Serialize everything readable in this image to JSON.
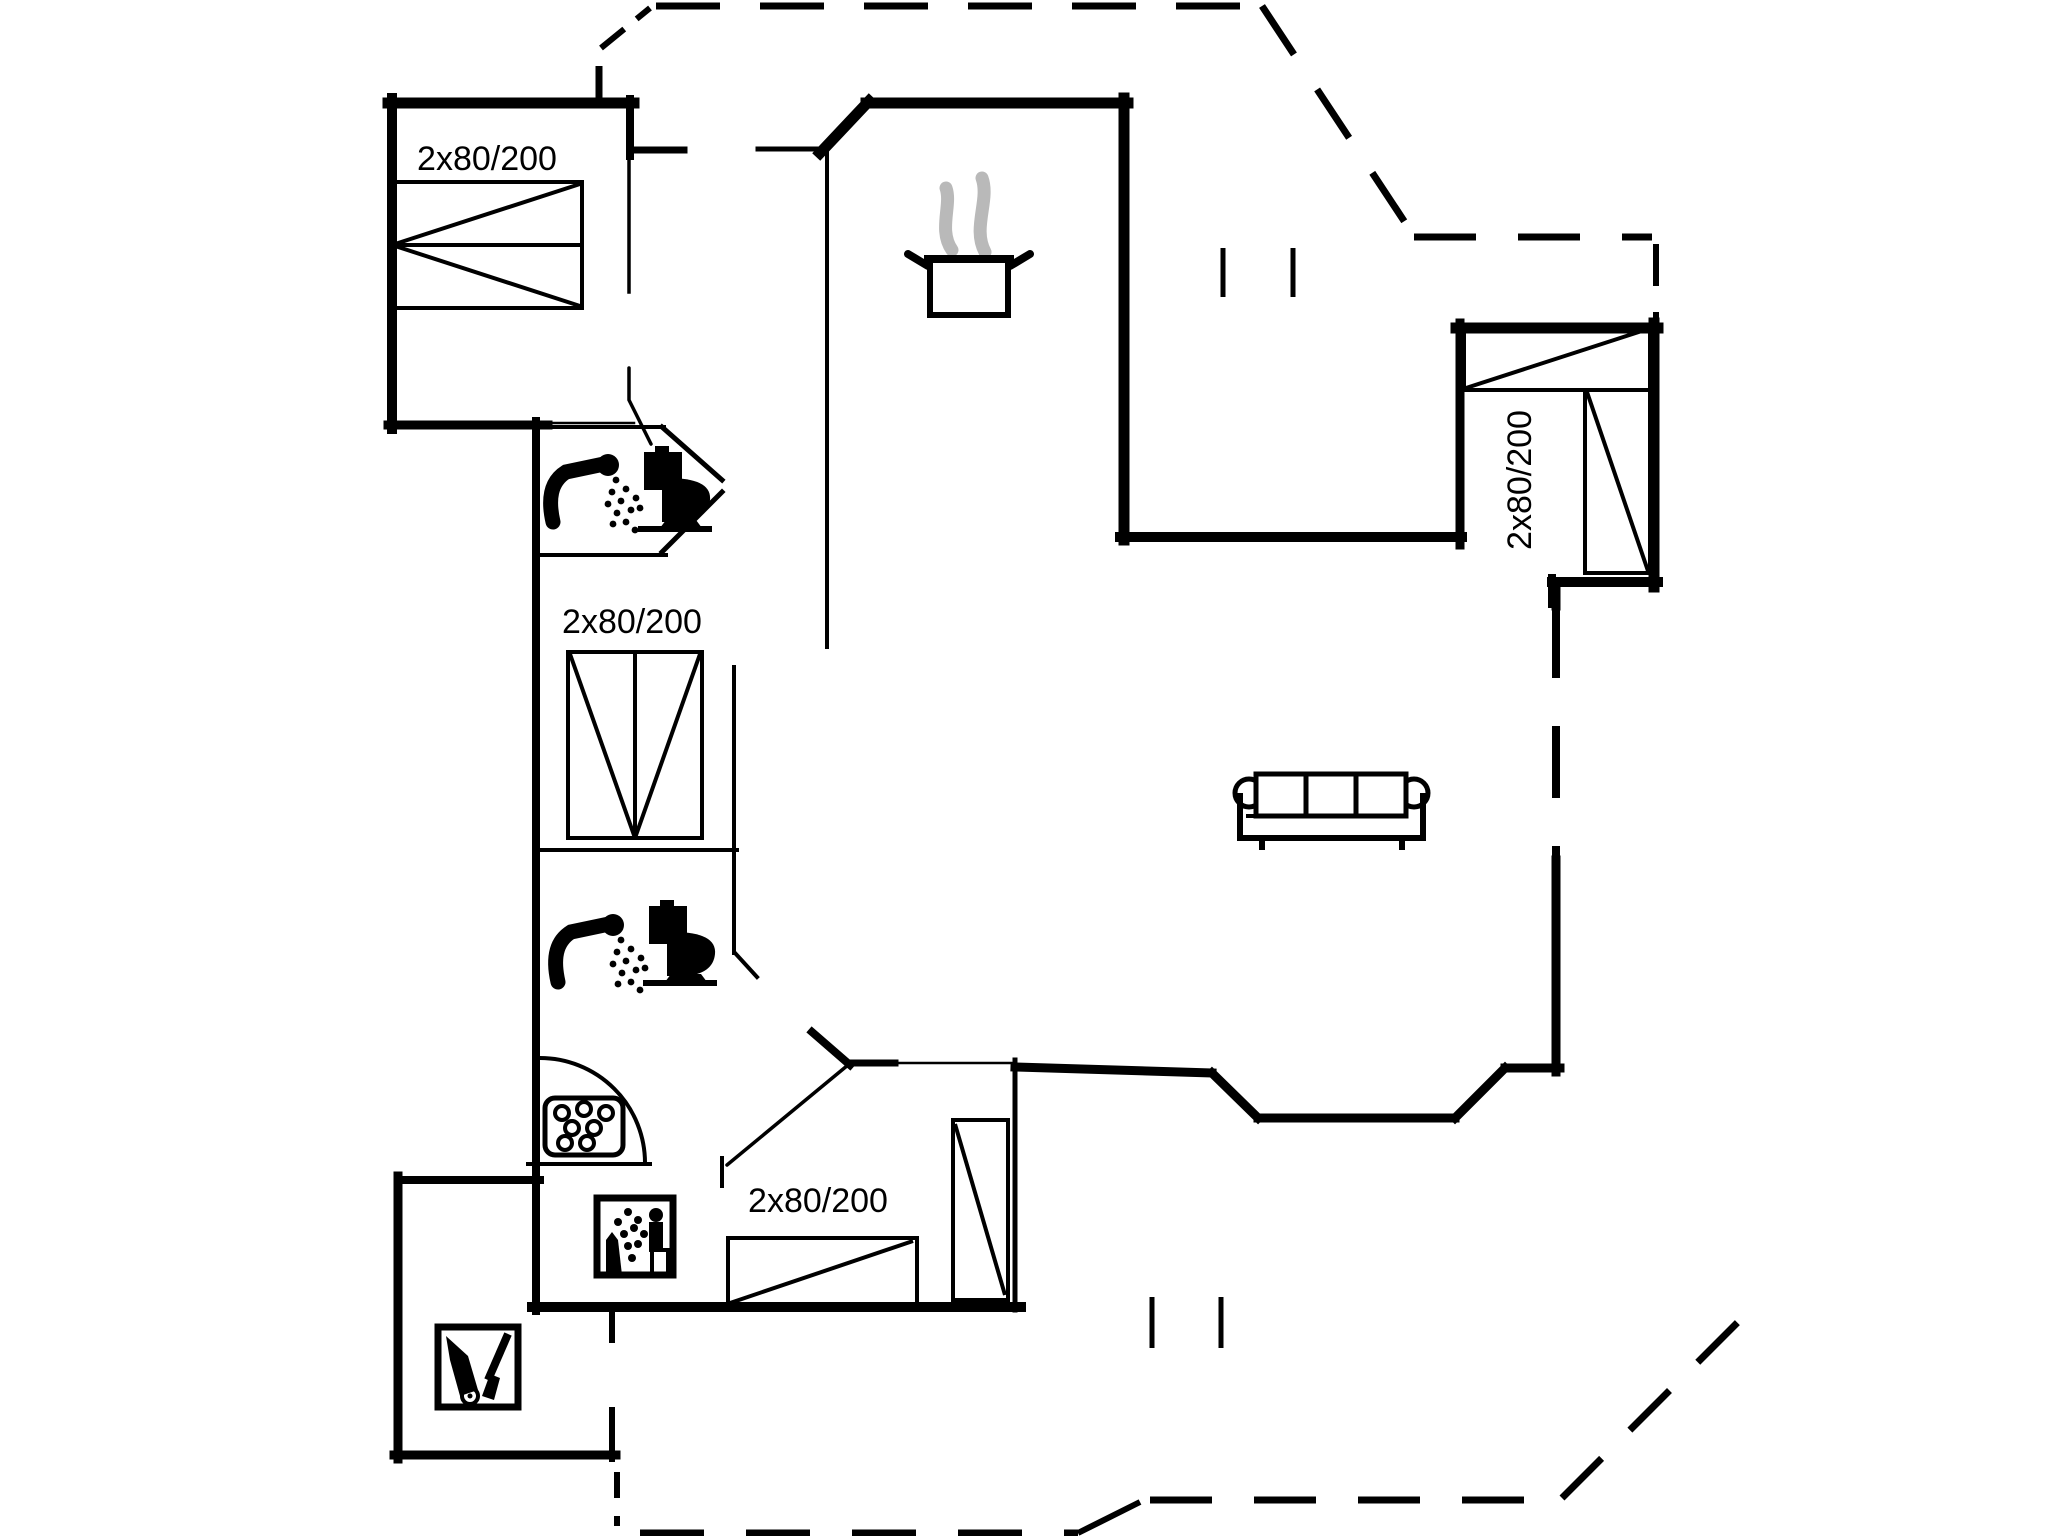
{
  "plan": {
    "type": "floor-plan",
    "bed_labels": {
      "bedroom_top_left": "2x80/200",
      "bedroom_middle_left": "2x80/200",
      "bedroom_right": "2x80/200",
      "bedroom_bottom": "2x80/200"
    },
    "icons": [
      "cooking-pot-steam-icon",
      "shower-icon",
      "toilet-icon",
      "shower-icon",
      "toilet-icon",
      "shower-tray-icon",
      "washing-machine-icon",
      "cleaning-equipment-icon",
      "sofa-icon",
      "double-bed-symbol",
      "door-swing-symbol"
    ],
    "colors": {
      "wall": "#000000",
      "steam": "#b9b9b9",
      "background": "#ffffff"
    }
  }
}
